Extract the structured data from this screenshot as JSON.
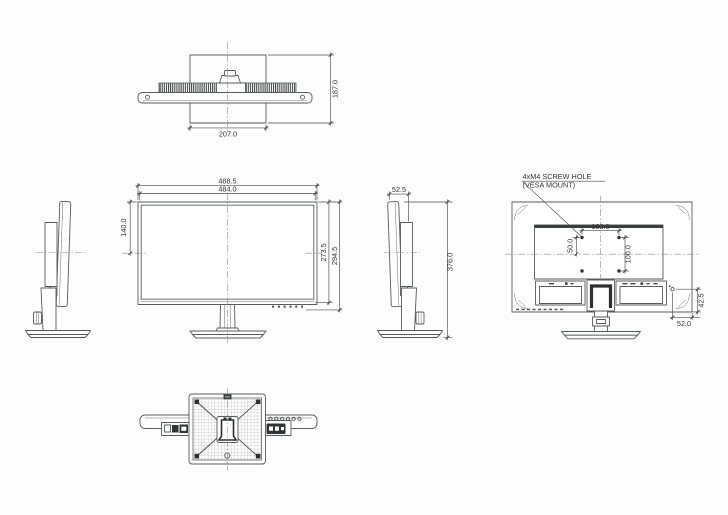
{
  "drawing": {
    "kind": "monitor-dimension-drawing",
    "colors": {
      "line": "#595a5c",
      "dark_fill": "#2f3032",
      "background": "#fdfdfd",
      "text": "#343434"
    },
    "views": {
      "top": {
        "base_width": "207.0",
        "total_depth": "187.0"
      },
      "front": {
        "outer_width": "488.5",
        "screen_width": "484.0",
        "top_to_center": "140.0",
        "screen_height": "273.5",
        "total_height": "294.5"
      },
      "side": {
        "panel_depth": "52.5",
        "total_height": "376.0"
      },
      "back": {
        "callout_line1": "4xM4 SCREW HOLE",
        "callout_line2": "(VESA MOUNT)",
        "vesa_width": "100.0",
        "vesa_height": "100.0",
        "center_to_hole": "50.0",
        "hole_to_bottom": "42.5",
        "hole_to_side": "52.0"
      }
    }
  }
}
